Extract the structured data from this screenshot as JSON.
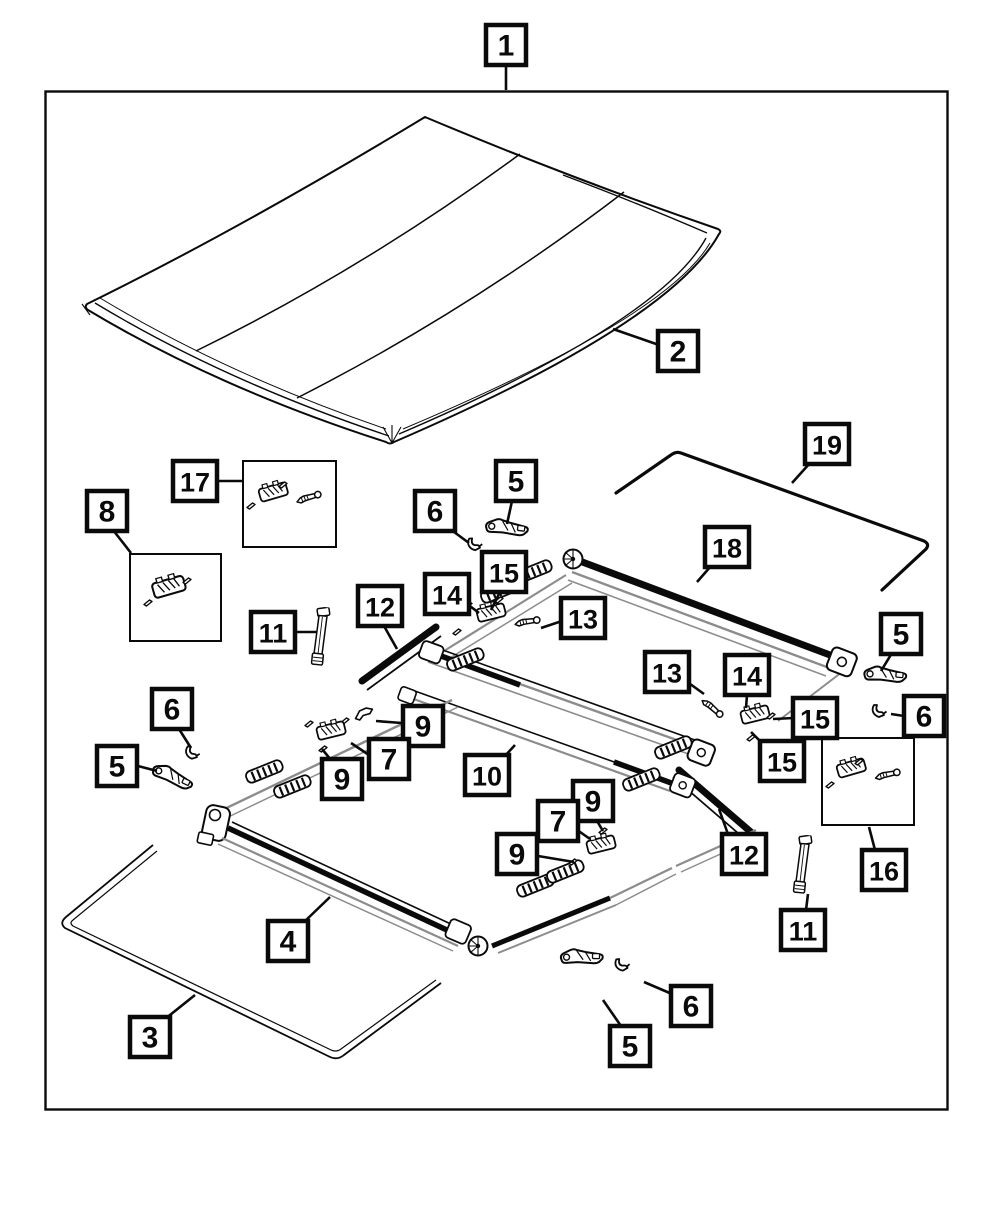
{
  "figure": {
    "kind": "exploded-parts-diagram",
    "visible_part_numbers": [
      "1",
      "2",
      "3",
      "4",
      "5",
      "6",
      "7",
      "8",
      "9",
      "10",
      "11",
      "12",
      "13",
      "14",
      "15",
      "16",
      "17",
      "18",
      "19"
    ]
  },
  "palette": {
    "ink": "#0a0a0a",
    "secondary": "#8c8c8c",
    "paper": "#ffffff"
  },
  "frame": {
    "x": 45,
    "y": 91,
    "w": 903,
    "h": 1019
  },
  "diagram": {
    "inset_boxes": [
      {
        "id": "hardware-box-17",
        "x": 243,
        "y": 461,
        "w": 93,
        "h": 86
      },
      {
        "id": "hardware-box-8",
        "x": 130,
        "y": 554,
        "w": 91,
        "h": 87
      },
      {
        "id": "hardware-box-16",
        "x": 822,
        "y": 738,
        "w": 92,
        "h": 87
      }
    ],
    "callouts": [
      {
        "label": "1",
        "x": 506,
        "y": 45,
        "leader": [
          506,
          65,
          506,
          90
        ]
      },
      {
        "label": "2",
        "x": 678,
        "y": 351,
        "leader": [
          659,
          345,
          613,
          329
        ]
      },
      {
        "label": "17",
        "x": 195,
        "y": 481,
        "leader": [
          216,
          481,
          242,
          481
        ]
      },
      {
        "label": "8",
        "x": 107,
        "y": 511,
        "leader": [
          113,
          530,
          131,
          553
        ]
      },
      {
        "label": "5",
        "x": 516,
        "y": 481,
        "leader": [
          512,
          501,
          507,
          524
        ]
      },
      {
        "label": "6",
        "x": 435,
        "y": 511,
        "leader": [
          450,
          529,
          469,
          543
        ]
      },
      {
        "label": "15",
        "x": 504,
        "y": 572,
        "leader": [
          500,
          592,
          491,
          610
        ]
      },
      {
        "label": "14",
        "x": 447,
        "y": 594,
        "leader": [
          466,
          603,
          479,
          613
        ]
      },
      {
        "label": "13",
        "x": 583,
        "y": 618,
        "leader": [
          562,
          621,
          541,
          628
        ]
      },
      {
        "label": "12",
        "x": 380,
        "y": 606,
        "leader": [
          384,
          626,
          397,
          649
        ]
      },
      {
        "label": "11",
        "x": 273,
        "y": 632,
        "leader": [
          294,
          632,
          317,
          632
        ]
      },
      {
        "label": "18",
        "x": 727,
        "y": 547,
        "leader": [
          711,
          566,
          697,
          582
        ]
      },
      {
        "label": "19",
        "x": 827,
        "y": 444,
        "leader": [
          810,
          463,
          792,
          483
        ]
      },
      {
        "label": "5",
        "x": 901,
        "y": 634,
        "leader": [
          892,
          653,
          881,
          671
        ]
      },
      {
        "label": "6",
        "x": 924,
        "y": 716,
        "leader": [
          904,
          716,
          891,
          714
        ]
      },
      {
        "label": "15",
        "x": 815,
        "y": 718,
        "leader": [
          794,
          718,
          773,
          719
        ]
      },
      {
        "label": "15",
        "x": 782,
        "y": 761,
        "leader": [
          765,
          746,
          751,
          732
        ]
      },
      {
        "label": "13",
        "x": 667,
        "y": 672,
        "leader": [
          686,
          681,
          704,
          694
        ]
      },
      {
        "label": "14",
        "x": 747,
        "y": 675,
        "leader": [
          747,
          695,
          746,
          708
        ]
      },
      {
        "label": "10",
        "x": 487,
        "y": 775,
        "leader": [
          504,
          757,
          515,
          745
        ]
      },
      {
        "label": "9",
        "x": 423,
        "y": 726,
        "leader": [
          402,
          723,
          376,
          721
        ]
      },
      {
        "label": "7",
        "x": 389,
        "y": 759,
        "leader": [
          369,
          755,
          351,
          743
        ]
      },
      {
        "label": "9",
        "x": 342,
        "y": 779,
        "leader": [
          331,
          760,
          322,
          749
        ]
      },
      {
        "label": "9",
        "x": 593,
        "y": 801,
        "leader": [
          597,
          821,
          603,
          831
        ]
      },
      {
        "label": "7",
        "x": 558,
        "y": 821,
        "leader": [
          573,
          827,
          590,
          839
        ]
      },
      {
        "label": "9",
        "x": 517,
        "y": 854,
        "leader": [
          538,
          856,
          574,
          862
        ]
      },
      {
        "label": "12",
        "x": 744,
        "y": 854,
        "leader": [
          729,
          837,
          719,
          809
        ]
      },
      {
        "label": "16",
        "x": 884,
        "y": 870,
        "leader": [
          875,
          850,
          869,
          827
        ]
      },
      {
        "label": "11",
        "x": 803,
        "y": 930,
        "leader": [
          806,
          910,
          808,
          894
        ]
      },
      {
        "label": "4",
        "x": 288,
        "y": 941,
        "leader": [
          303,
          923,
          330,
          897
        ]
      },
      {
        "label": "3",
        "x": 150,
        "y": 1037,
        "leader": [
          165,
          1019,
          195,
          995
        ]
      },
      {
        "label": "5",
        "x": 630,
        "y": 1046,
        "leader": [
          621,
          1026,
          603,
          1000
        ]
      },
      {
        "label": "6",
        "x": 691,
        "y": 1006,
        "leader": [
          672,
          994,
          644,
          982
        ]
      },
      {
        "label": "6",
        "x": 172,
        "y": 709,
        "leader": [
          179,
          729,
          191,
          748
        ]
      },
      {
        "label": "5",
        "x": 117,
        "y": 766,
        "leader": [
          138,
          766,
          157,
          771
        ]
      }
    ]
  }
}
